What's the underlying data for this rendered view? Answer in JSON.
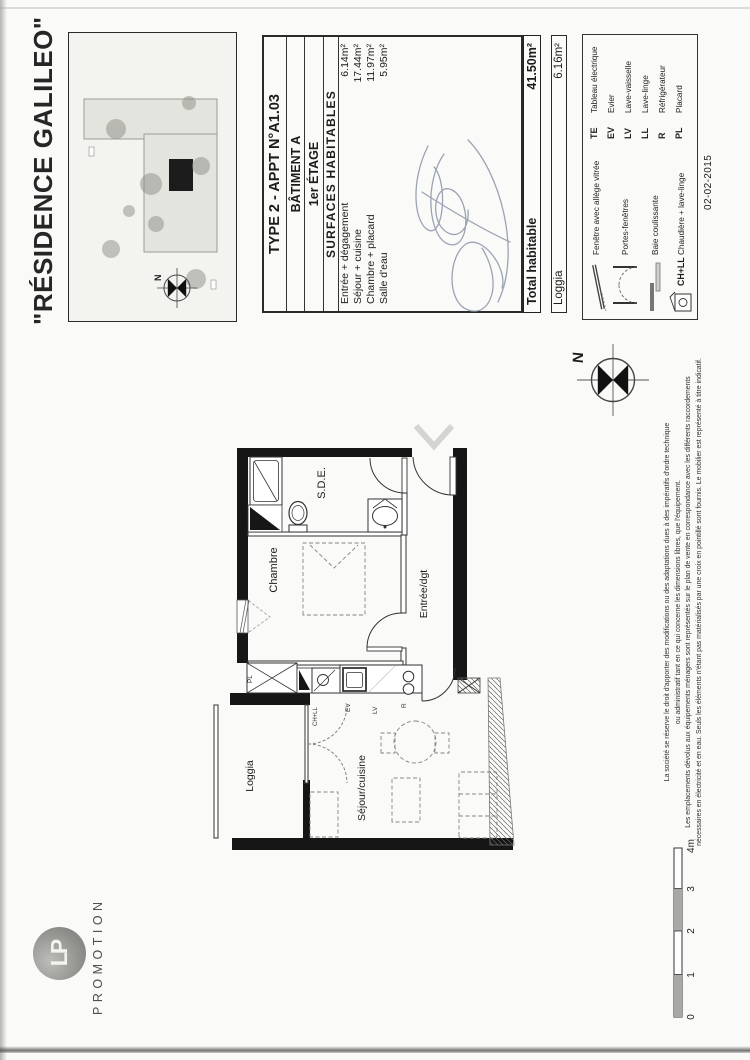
{
  "title": "\"RÉSIDENCE GALILEO\"",
  "logo": {
    "initials": "LP",
    "subtitle": "PROMOTION"
  },
  "apartment": {
    "type_line": "TYPE 2 - APPT N°A1.03",
    "building": "BÂTIMENT A",
    "floor": "1er ÉTAGE",
    "surfaces_title": "SURFACES HABITABLES",
    "rows": [
      {
        "label": "Entrée + dégagement",
        "value": "6.14m²"
      },
      {
        "label": "Séjour + cuisine",
        "value": "17.44m²"
      },
      {
        "label": "Chambre + placard",
        "value": "11.97m²"
      },
      {
        "label": "Salle d'eau",
        "value": "5.95m²"
      }
    ],
    "total_label": "Total habitable",
    "total_value": "41.50m²",
    "loggia_label": "Loggia",
    "loggia_value": "6.16m²"
  },
  "legend": {
    "window_label": "Fenêtre avec allège vitrée",
    "french_doors_label": "Portes-fenêtres",
    "sliding_label": "Baie coulissante",
    "boiler_abbr": "CH+LL",
    "boiler_label": "Chaudière + lave-linge",
    "abbreviations": [
      {
        "abbr": "TE",
        "label": "Tableau électrique"
      },
      {
        "abbr": "EV",
        "label": "Evier"
      },
      {
        "abbr": "LV",
        "label": "Lave-vaisselle"
      },
      {
        "abbr": "LL",
        "label": "Lave-linge"
      },
      {
        "abbr": "R",
        "label": "Réfrigérateur"
      },
      {
        "abbr": "PL",
        "label": "Placard"
      }
    ]
  },
  "date": "02-02-2015",
  "compass": {
    "north": "N"
  },
  "plan": {
    "rooms": {
      "chambre": "Chambre",
      "sde": "S.D.E.",
      "entree": "Entrée/dgt",
      "sejour": "Séjour/cuisine",
      "loggia": "Loggia"
    },
    "tags": {
      "ev": "EV",
      "lv": "LV",
      "r": "R",
      "chll": "CH+LL",
      "pl": "PL"
    }
  },
  "scale": {
    "t0": "0",
    "t1": "1",
    "t2": "2",
    "t3": "3",
    "t4": "4m"
  },
  "disclaimer": {
    "line1": "La société se réserve le droit d'apporter des modifications ou des adaptations dues à des impératifs d'ordre technique",
    "line2": "ou administratif tant en ce qui concerne les dimensions libres, que l'équipement.",
    "line3": "Les emplacements dévolus aux équipements ménagers sont représentés sur le plan de vente en correspondance avec les différents raccordements",
    "line4": "nécessaires en électricité et en eau. Seuls les éléments n'étant pas matérialisés par une croix en pointillé sont fournis. Le mobilier est représenté à titre indicatif."
  }
}
